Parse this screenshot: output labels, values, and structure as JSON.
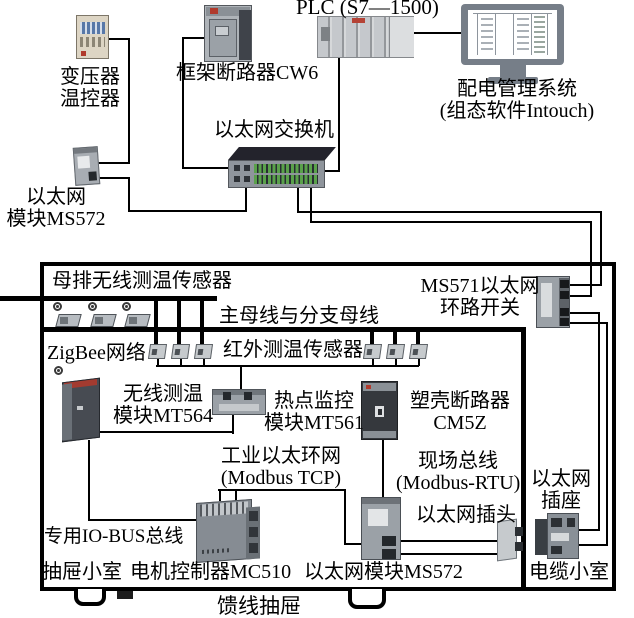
{
  "palette": {
    "line": "#000000",
    "device_gray": "#9aa1a7",
    "device_dark": "#3d4147",
    "port_green": "#5aa14b",
    "screen_blue": "#5878a8",
    "accent_red": "#b03a2c",
    "monitor_gray": "#767e88",
    "beige": "#ddd5c4"
  },
  "nodes": {
    "plc": {
      "label": "PLC (S7—1500)"
    },
    "transformer_controller": {
      "label_lines": [
        "变压器",
        "温控器"
      ]
    },
    "frame_breaker": {
      "label": "框架断路器CW6"
    },
    "ethernet_switch": {
      "label": "以太网交换机"
    },
    "management_system": {
      "label_lines": [
        "配电管理系统",
        "(组态软件Intouch)"
      ]
    },
    "ethernet_module_left": {
      "label_lines": [
        "以太网",
        "模块MS572"
      ]
    },
    "busbar_wireless_sensor": {
      "label": "母排无线测温传感器"
    },
    "main_busbar": {
      "label": "主母线与分支母线"
    },
    "ms571_loop_switch": {
      "label_lines": [
        "MS571以太网",
        "环路开关"
      ]
    },
    "zigbee_network": {
      "label": "ZigBee网络"
    },
    "infrared_sensor": {
      "label": "红外测温传感器"
    },
    "mt564": {
      "label_lines": [
        "无线测温",
        "模块MT564"
      ]
    },
    "mt561": {
      "label_lines": [
        "热点监控",
        "模块MT561"
      ]
    },
    "cm5z": {
      "label_lines": [
        "塑壳断路器",
        "CM5Z"
      ]
    },
    "industrial_ring": {
      "label_lines": [
        "工业以太环网",
        "(Modbus TCP)"
      ]
    },
    "fieldbus": {
      "label_lines": [
        "现场总线",
        "(Modbus-RTU)"
      ]
    },
    "ethernet_plug": {
      "label": "以太网插头"
    },
    "ethernet_socket": {
      "label_lines": [
        "以太网",
        "插座"
      ]
    },
    "io_bus": {
      "label": "专用IO-BUS总线"
    },
    "drawer_cell": {
      "label": "抽屉小室"
    },
    "mc510": {
      "label": "电机控制器MC510"
    },
    "ethernet_module_ms572": {
      "label": "以太网模块MS572"
    },
    "cable_cell": {
      "label": "电缆小室"
    },
    "feeder_drawer": {
      "label": "馈线抽屉"
    }
  }
}
